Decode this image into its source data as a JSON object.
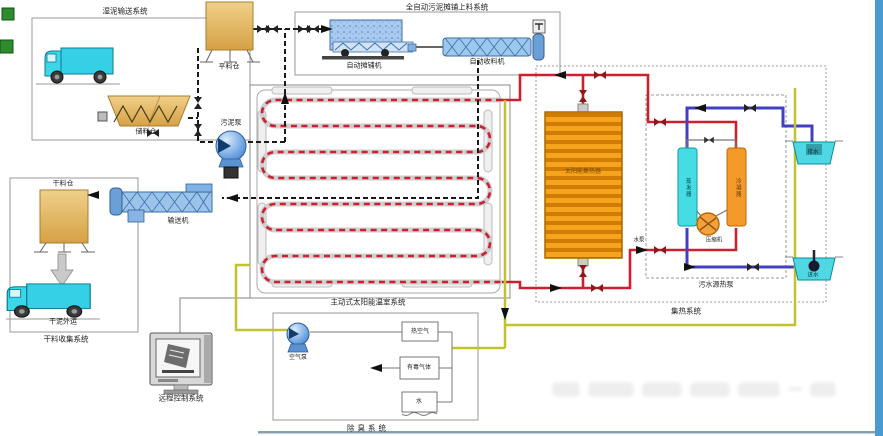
{
  "systems": {
    "wet_transport": "湿泥输送系统",
    "auto_spread": "全自动污泥摊铺上料系统",
    "greenhouse": "主动式太阳能温室系统",
    "dry_collect": "干料收集系统",
    "remote_control": "远程控制系统",
    "deodorization": "除臭系统",
    "heat_collect": "集热系统",
    "sewage_heat_pump": "污水源热泵"
  },
  "equipment": {
    "buffer_silo": "平料仓",
    "storage_hopper": "储料仓",
    "sludge_pump": "污泥泵",
    "auto_spreader": "自动摊铺机",
    "auto_collector": "自动收料机",
    "dry_silo": "干料仓",
    "conveyor": "输送机",
    "dry_out": "干泥外运",
    "solar_collector": "太阳能集热器"
  },
  "deodorization": {
    "air_pump": "空气泵",
    "hot_air": "热空气",
    "toxic_gas": "有毒气体",
    "water": "水"
  },
  "heat_pump": {
    "evaporator": "蒸发器",
    "condenser": "冷凝器",
    "compressor": "压缩机",
    "water_pump": "水泵",
    "drain": "排水",
    "inlet": "进水"
  },
  "colors": {
    "pipe_hot": "#cc2030",
    "pipe_sludge": "#1a1a1a",
    "pipe_air": "#c2c22e",
    "pipe_water": "#4040c0",
    "tank_sand": "#e0af5c",
    "machine_blue": "#9cc3ea",
    "radiator_orange": "#f29a10",
    "truck_cyan": "#35d5e8"
  }
}
